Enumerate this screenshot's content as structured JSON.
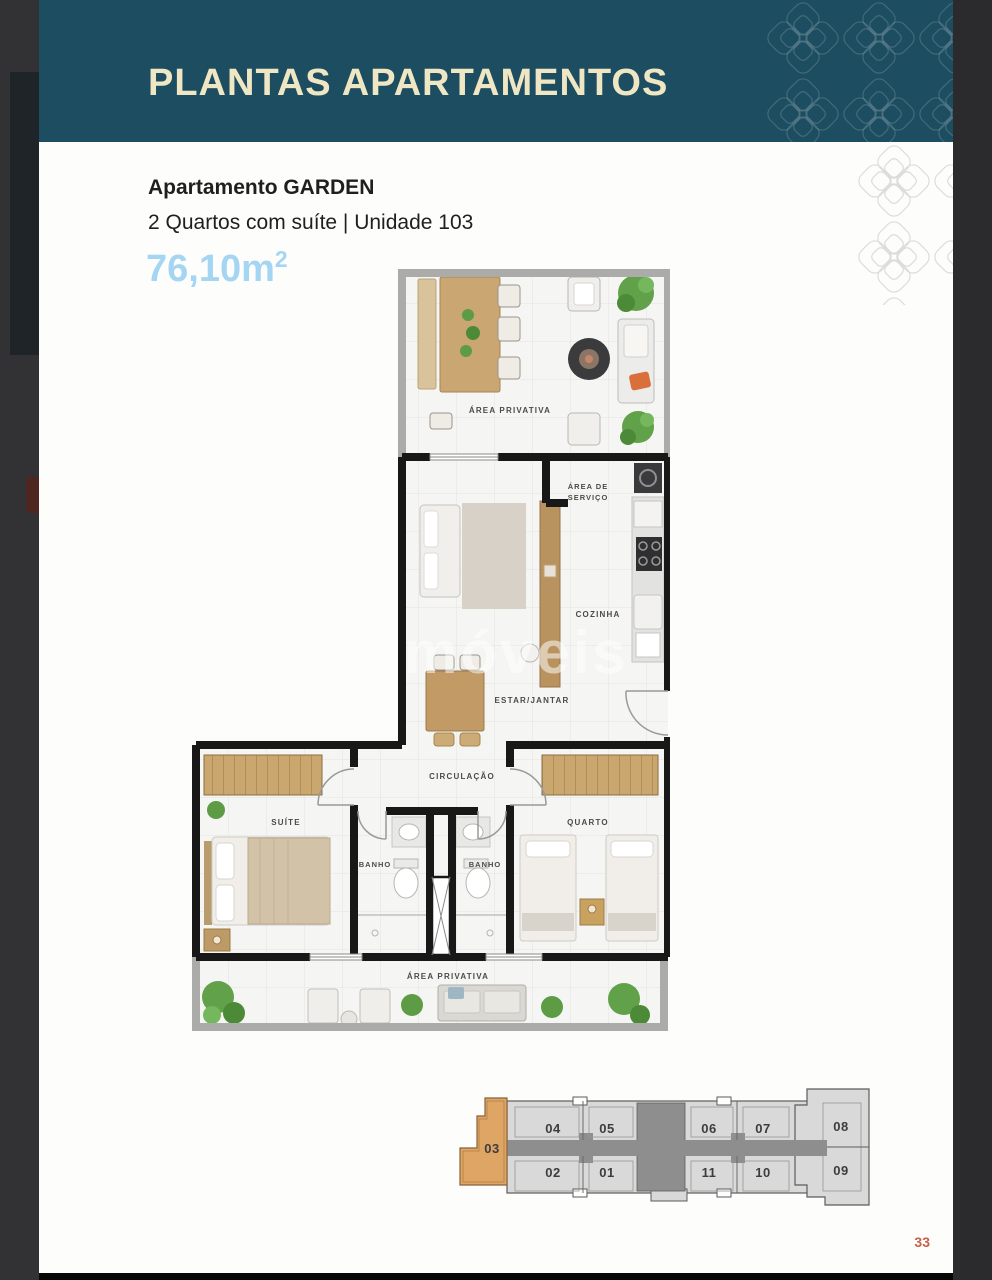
{
  "header": {
    "title": "PLANTAS APARTAMENTOS"
  },
  "apartment": {
    "name": "Apartamento GARDEN",
    "specs": "2 Quartos com suíte | Unidade 103",
    "area_value": "76,10m",
    "area_sup": "2"
  },
  "floor_plan": {
    "watermark": "móveis",
    "labels": {
      "terrace_top": "ÁREA PRIVATIVA",
      "service_line1": "ÁREA DE",
      "service_line2": "SERVIÇO",
      "kitchen": "COZINHA",
      "living": "ESTAR/JANTAR",
      "hall": "CIRCULAÇÃO",
      "suite": "SUÍTE",
      "bath_left": "BANHO",
      "bath_right": "BANHO",
      "bedroom": "QUARTO",
      "terrace_bottom": "ÁREA PRIVATIVA"
    }
  },
  "key_plan": {
    "highlight_unit": "03",
    "units_top": [
      "04",
      "05",
      "06",
      "07",
      "08"
    ],
    "units_bottom": [
      "02",
      "01",
      "11",
      "10",
      "09"
    ]
  },
  "footer": {
    "page_number": "33"
  },
  "colors": {
    "header_teal": "#1d4d60",
    "title_cream": "#efe6c4",
    "area_blue": "#a4d6f4",
    "page_number_orange": "#c7604c",
    "highlight_orange": "#dfa565"
  }
}
